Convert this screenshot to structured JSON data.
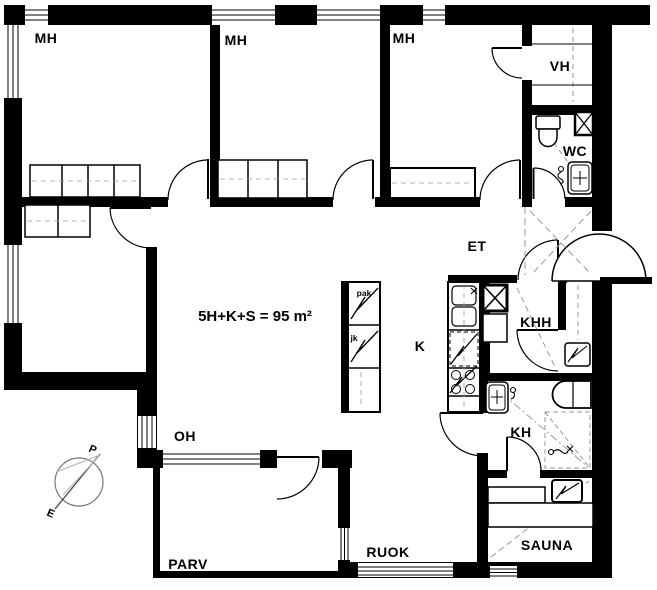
{
  "plan": {
    "title": "5H+K+S = 95 m²",
    "rooms": {
      "mh1": "MH",
      "mh2": "MH",
      "mh3": "MH",
      "vh": "VH",
      "wc": "WC",
      "et": "ET",
      "khh": "KHH",
      "k": "K",
      "kh": "KH",
      "oh": "OH",
      "parv": "PARV",
      "ruok": "RUOK",
      "sauna": "SAUNA"
    },
    "appliances": {
      "freezer": "pak",
      "fridge": "jk"
    },
    "compass": {
      "north": "P",
      "south": "E"
    },
    "colors": {
      "wall": "#000000",
      "floor": "#ffffff",
      "dash": "#999999"
    }
  }
}
